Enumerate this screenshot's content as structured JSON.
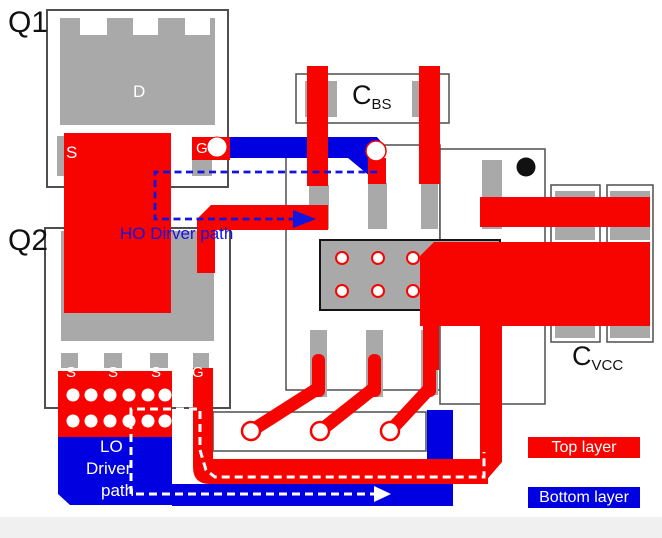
{
  "labels": {
    "q1": "Q1",
    "q2": "Q2",
    "cbs_main": "C",
    "cbs_sub": "BS",
    "cvcc_main": "C",
    "cvcc_sub": "VCC"
  },
  "pads": {
    "q1_drain": "D",
    "q1_source": "S",
    "q1_gate": "G",
    "q2_sources": [
      "S",
      "S",
      "S"
    ],
    "q2_gate": "G"
  },
  "annotations": {
    "ho_path": "HO Dirver path",
    "lo_lines": [
      "LO",
      "Driver",
      "path"
    ]
  },
  "legend": {
    "top": "Top layer",
    "bottom": "Bottom layer"
  },
  "colors": {
    "top_layer": "#f80400",
    "bottom_layer": "#0000e0",
    "pad_gray": "#a9a9a9",
    "outline_gray": "#4f4f4f",
    "annotation_blue": "#1414e0",
    "annotation_white": "#ffffff"
  }
}
